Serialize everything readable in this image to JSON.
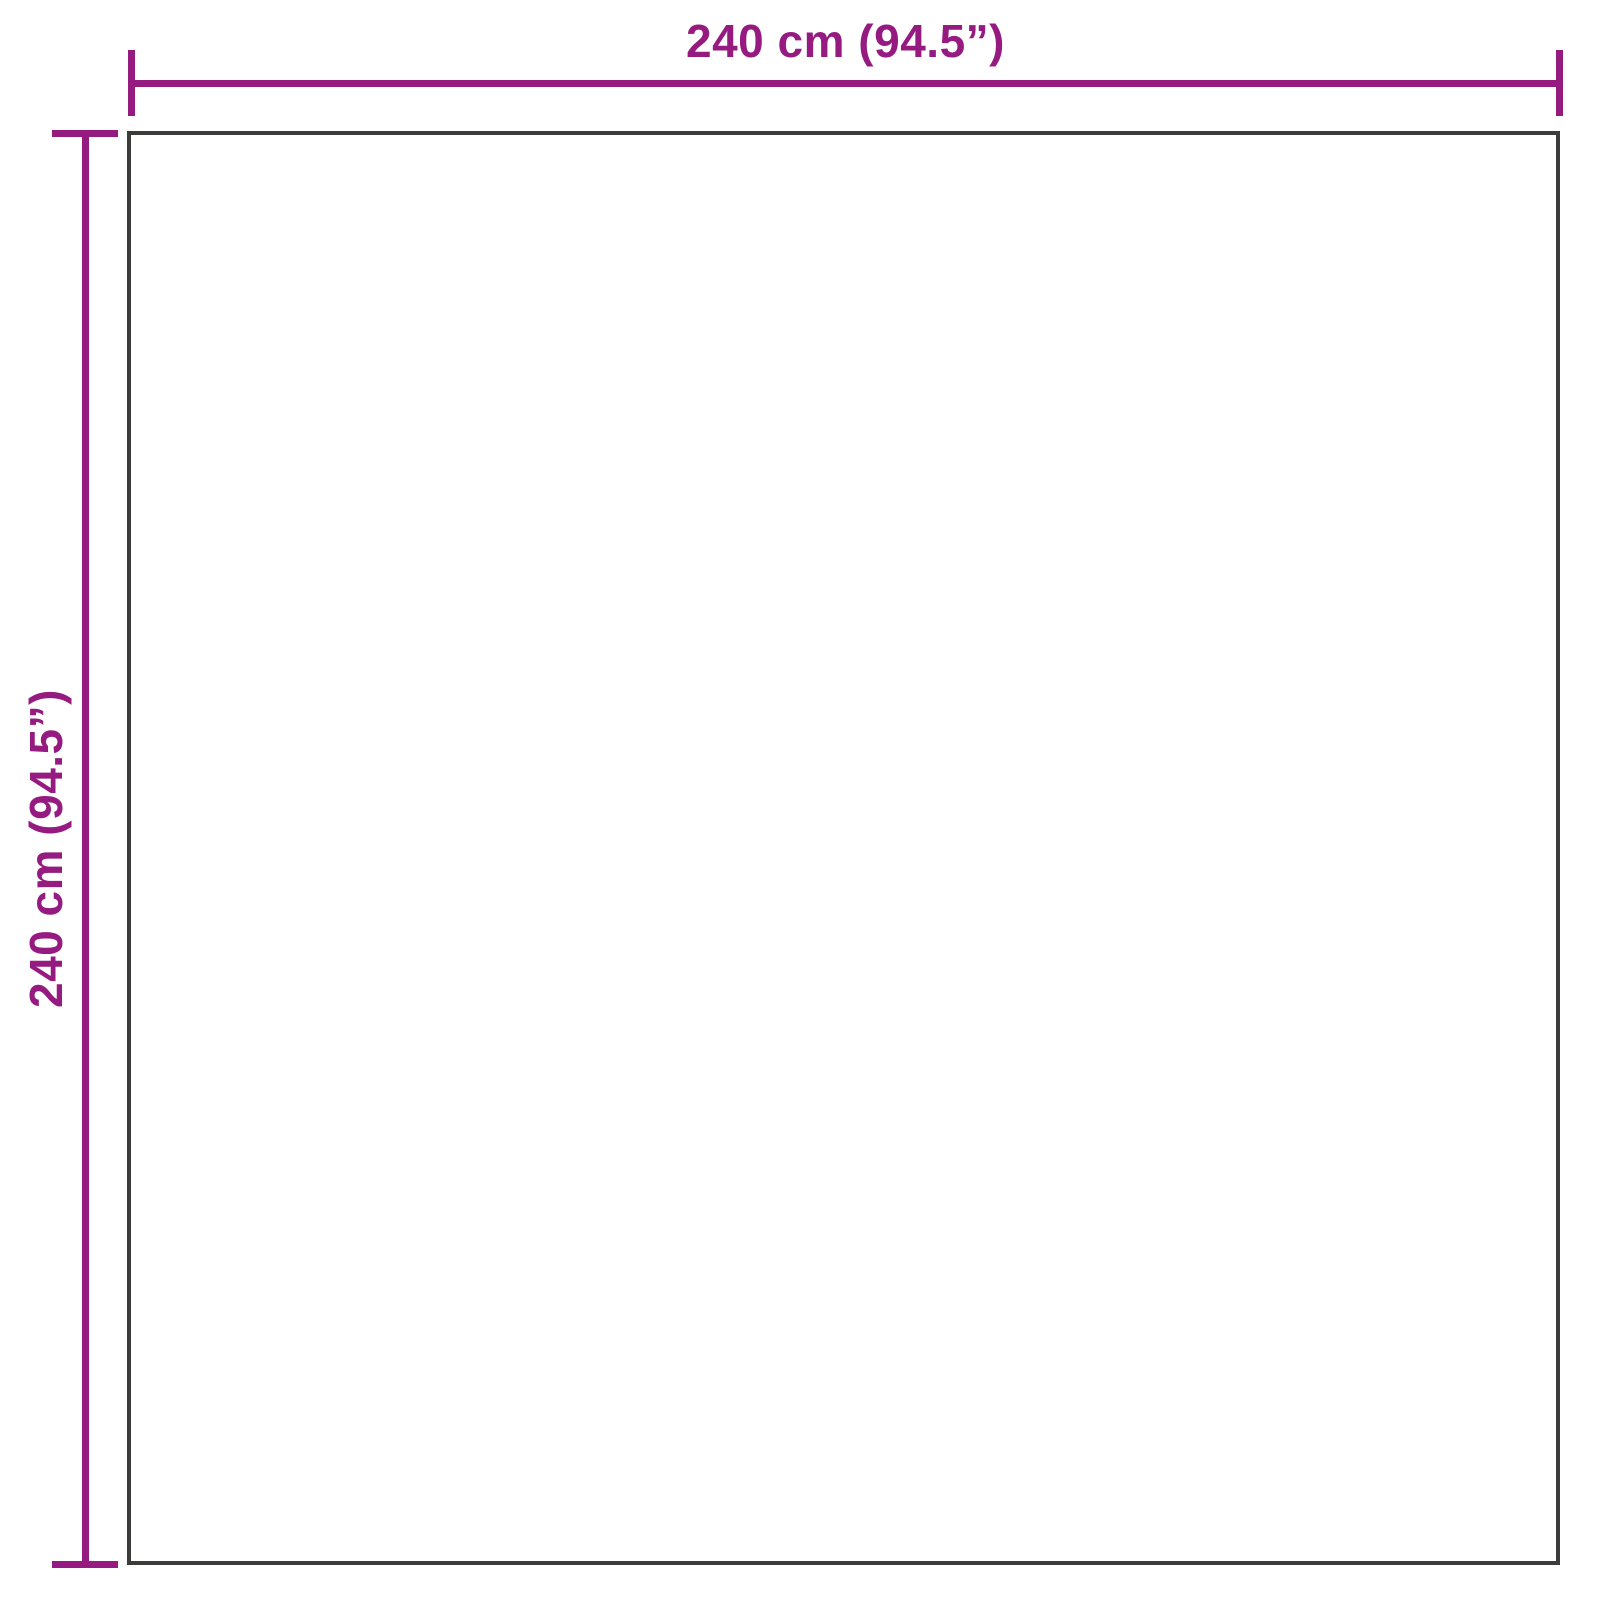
{
  "diagram": {
    "kind": "product-dimension-diagram",
    "shape": "square",
    "top_dimension": {
      "label": "240 cm (94.5”)",
      "value_cm": 240,
      "value_in": 94.5
    },
    "left_dimension": {
      "label": "240 cm (94.5”)",
      "value_cm": 240,
      "value_in": 94.5
    },
    "colors": {
      "dimension": "#951b81",
      "outline": "#3c3c3b",
      "background": "#ffffff"
    }
  }
}
